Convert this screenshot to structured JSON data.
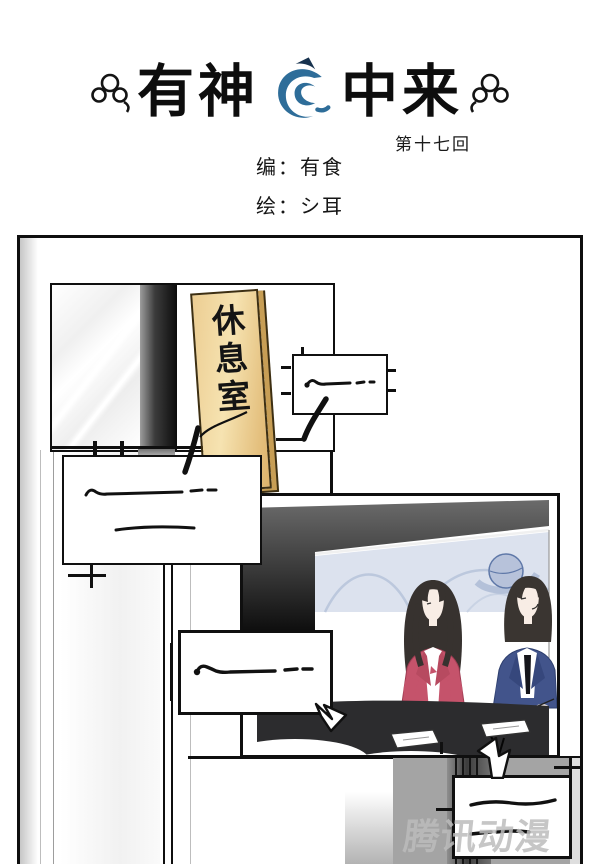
{
  "header": {
    "title_left": "有神",
    "title_right": "中来",
    "chapter": "第十七回",
    "credits": {
      "editor": "编：有食",
      "artist": "绘：シ耳"
    }
  },
  "panel": {
    "sign": {
      "text": "休息室",
      "subtext": "lounge"
    },
    "bubbles": [
      {
        "id": "bubble-1",
        "scribble_lines": 1
      },
      {
        "id": "bubble-2",
        "scribble_lines": 2
      },
      {
        "id": "bubble-3",
        "scribble_lines": 1
      },
      {
        "id": "bubble-4",
        "scribble_lines": 2
      }
    ],
    "watermark": "腾讯动漫",
    "colors": {
      "logo_blue": "#2e6d99",
      "sign_gold": "#ecc98b",
      "anchor_jacket_red": "#c5536b",
      "anchor_suit_navy": "#42548b",
      "tv_backdrop_blue": "#dce2ee",
      "desk_black": "#2c2c2e"
    }
  }
}
